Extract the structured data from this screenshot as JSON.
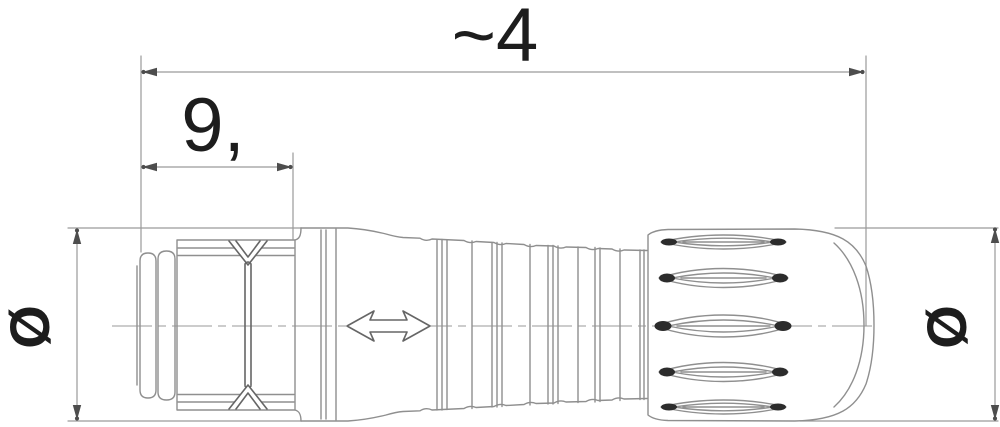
{
  "figure": {
    "type": "technical-drawing",
    "subject": "Circular cable connector, side view with dimension lines",
    "dimensions": {
      "overall_length_label": "~4",
      "front_length_label": "9,",
      "diameter_left_label": "Ø",
      "diameter_right_label": "Ø"
    },
    "icons": {
      "push_pull_arrow": "double-headed horizontal arrow marking on connector body",
      "dimension_arrowheads": "filled triangular dimension arrowheads"
    },
    "colors": {
      "background": "#ffffff",
      "line": "#8f8f8f",
      "line_dark": "#666666",
      "dim_line": "#9a9a9a",
      "arrow": "#4d4d4d",
      "text": "#1d1d1d",
      "slot_tip": "#2c2c2c"
    }
  }
}
